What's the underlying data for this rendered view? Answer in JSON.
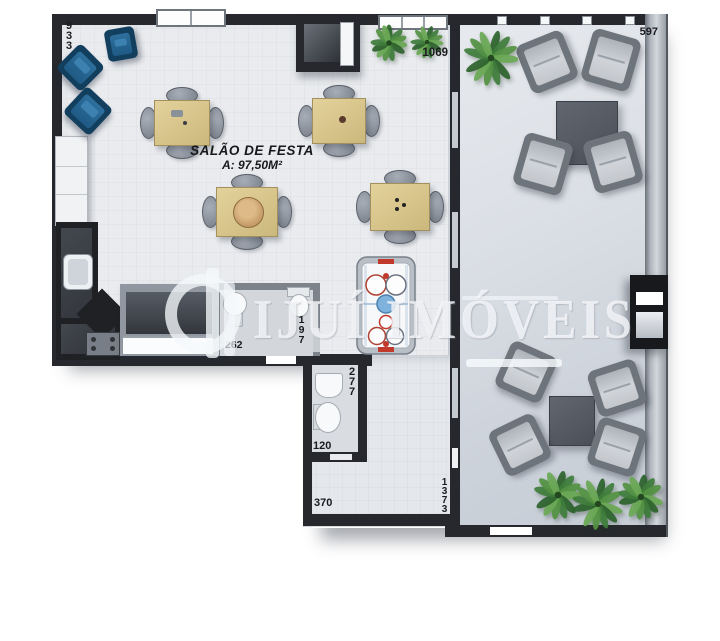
{
  "floorplan": {
    "title": {
      "name": "SALÃO DE FESTA",
      "area": "A: 97,50M²"
    },
    "watermark": {
      "brand": "IJUÍ IMÓVEIS"
    },
    "dimensions": {
      "top_left_height": "933",
      "salon_top_right": "1069",
      "lounge_top_width": "597",
      "bath1_width": "262",
      "bath1_height": "197",
      "bath2_height": "277",
      "bath2_width": "120",
      "hall_bottom_width": "370",
      "lounge_left_height": "1373"
    },
    "colors": {
      "wall": "#26282d",
      "floor_main": "#e9ebee",
      "floor_lounge": "#ccd2da",
      "armchair_blue": "#1f5a85",
      "table_wood": "#d8c68e",
      "plant_green": "#3f7d3c",
      "accent_red": "#c0392b",
      "accent_blue": "#5b9bd5",
      "watermark": "#f6f8fb"
    }
  }
}
